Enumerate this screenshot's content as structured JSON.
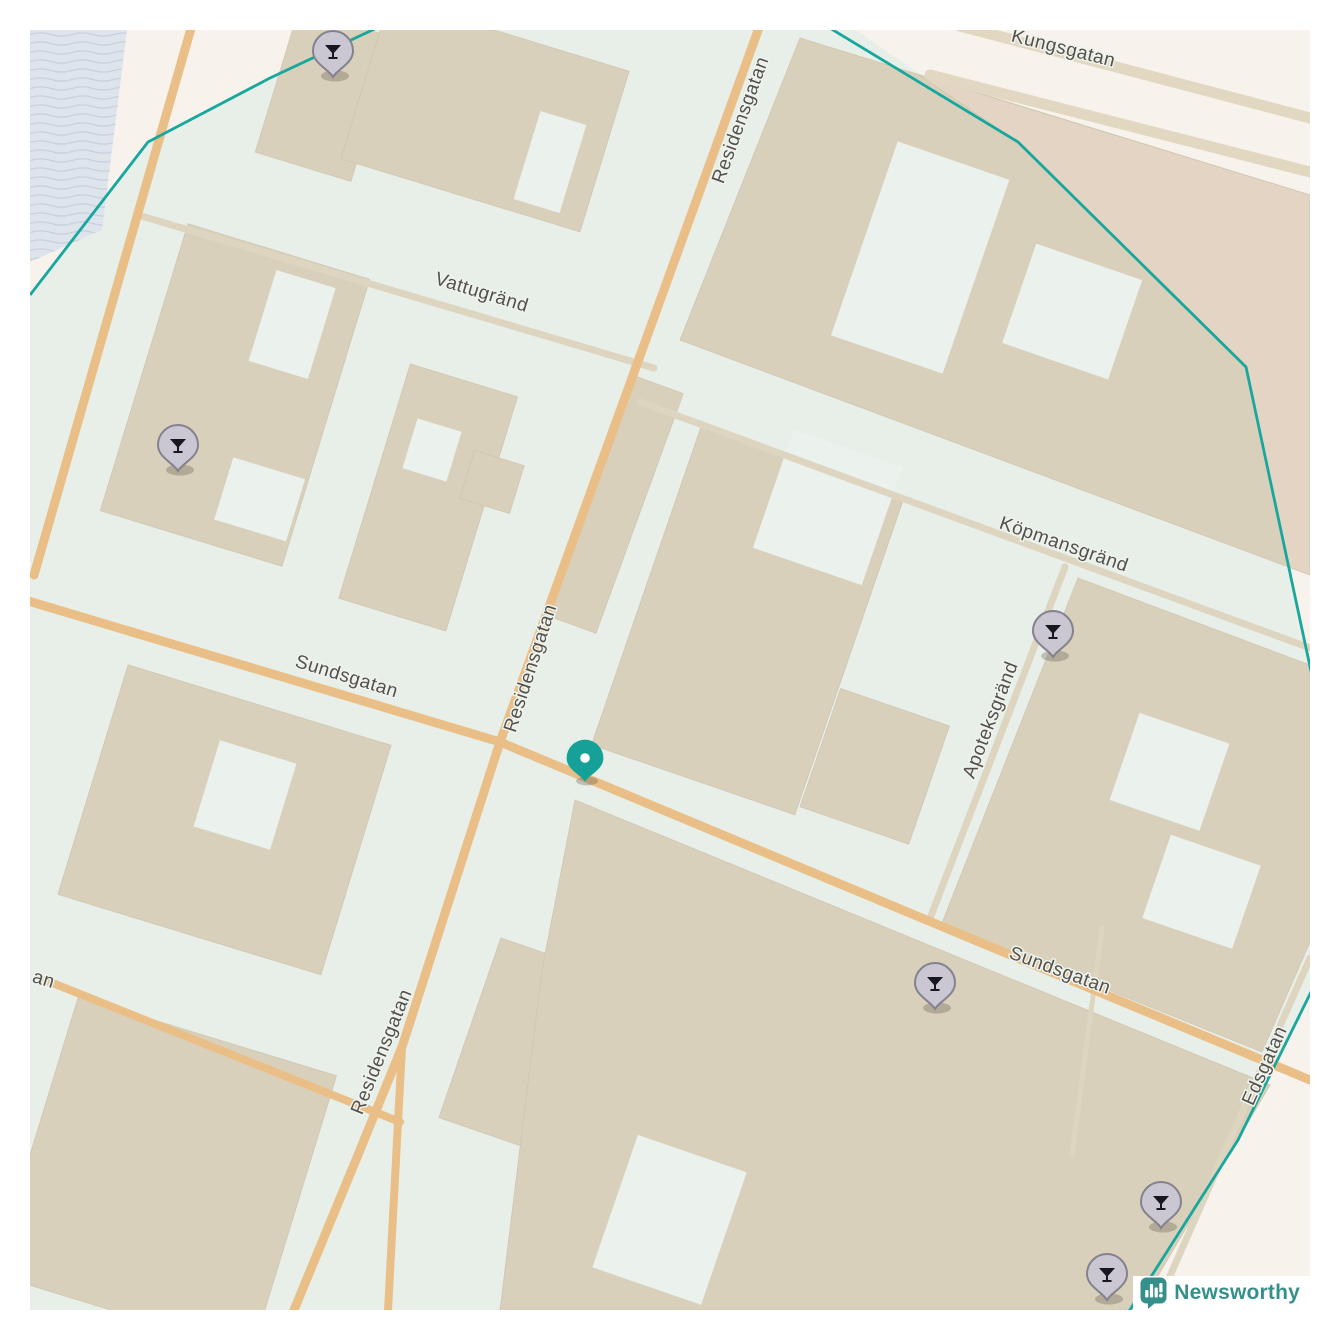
{
  "map": {
    "street_labels": [
      {
        "name": "Kungsgatan",
        "x": 1032,
        "y": 24,
        "rotation": 14
      },
      {
        "name": "Vattugränd",
        "x": 450,
        "y": 268,
        "rotation": 17
      },
      {
        "name": "Residensgatan",
        "x": 716,
        "y": 92,
        "rotation": -70
      },
      {
        "name": "Residensgatan",
        "x": 506,
        "y": 640,
        "rotation": -72
      },
      {
        "name": "Residensgatan",
        "x": 357,
        "y": 1024,
        "rotation": -68
      },
      {
        "name": "Sundsgatan",
        "x": 315,
        "y": 652,
        "rotation": 17
      },
      {
        "name": "Sundsgatan",
        "x": 1028,
        "y": 946,
        "rotation": 20
      },
      {
        "name": "Köpmansgränd",
        "x": 1032,
        "y": 520,
        "rotation": 19
      },
      {
        "name": "Apoteksgränd",
        "x": 966,
        "y": 692,
        "rotation": -69
      },
      {
        "name": "Edsgatan",
        "x": 1240,
        "y": 1038,
        "rotation": -66
      },
      {
        "name": "an",
        "x": 12,
        "y": 955,
        "rotation": 17
      }
    ],
    "bar_markers": [
      {
        "x": 303,
        "y": 47
      },
      {
        "x": 148,
        "y": 441
      },
      {
        "x": 1023,
        "y": 627
      },
      {
        "x": 905,
        "y": 979
      },
      {
        "x": 1131,
        "y": 1198
      },
      {
        "x": 1077,
        "y": 1270
      }
    ],
    "location_marker": {
      "x": 555,
      "y": 752
    },
    "colors": {
      "land": "#f7f3ec",
      "zone": "#e8efe9",
      "water": "#dee4ec",
      "wave": "#c7d0dc",
      "building": "#d9d0bb",
      "building_outer": "#e3d4c4",
      "courtyard": "#ebf1ec",
      "road_major": "#e9bf87",
      "road_minor": "#ded5c0",
      "road_wide": "#e2d8c2",
      "boundary": "#18a79d",
      "label": "#54504a",
      "halo": "#eff3ee",
      "pin": "#cac7d3",
      "pin_border": "#85828f",
      "glyph": "#17171d",
      "location": "#16a198",
      "brand": "#35908c"
    },
    "attribution": {
      "brand": "Newsworthy"
    }
  }
}
